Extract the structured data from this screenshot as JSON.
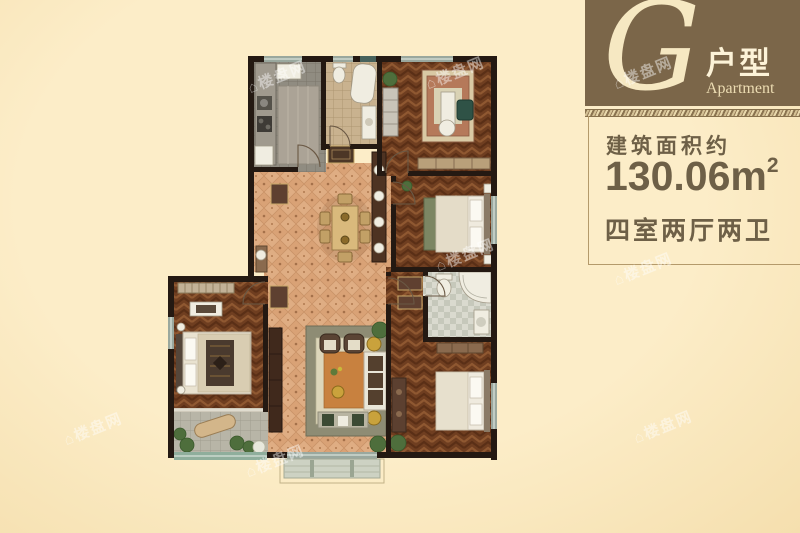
{
  "badge": {
    "letter": "G",
    "type_label": "户型",
    "subtitle": "Apartment"
  },
  "info": {
    "area_label": "建筑面积约",
    "area_value": "130.06m",
    "area_sup": "2",
    "rooms_label": "四室两厅两卫"
  },
  "watermark_text": "⌂楼盘网",
  "colors": {
    "bg": "#fcedc8",
    "header_bg": "#7b6649",
    "header_text": "#f6e8c2",
    "info_text": "#6e6047",
    "frame_line": "#b49a6b",
    "wall": "#241912",
    "window": "#9aa89e"
  }
}
